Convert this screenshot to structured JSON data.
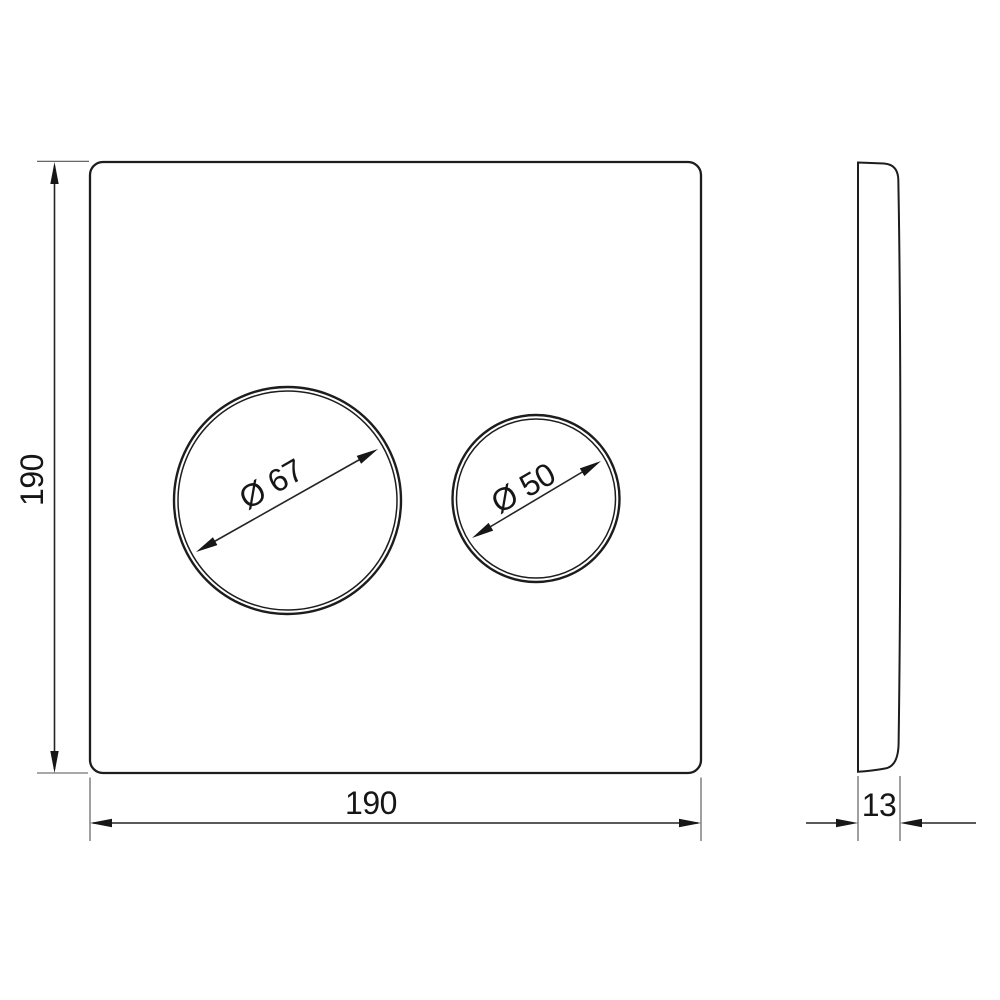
{
  "drawing": {
    "type": "technical-drawing",
    "views": [
      "front",
      "side"
    ]
  },
  "dimensions": {
    "plate_height": {
      "label": "190"
    },
    "plate_width": {
      "label": "190"
    },
    "plate_thickness": {
      "label": "13"
    },
    "large_button_diameter": {
      "label": "Ø 67"
    },
    "small_button_diameter": {
      "label": "Ø 50"
    }
  },
  "colors": {
    "line": "#1d1d1d",
    "dimension_line": "#242424",
    "extension_line": "#525252",
    "background": "#ffffff"
  }
}
